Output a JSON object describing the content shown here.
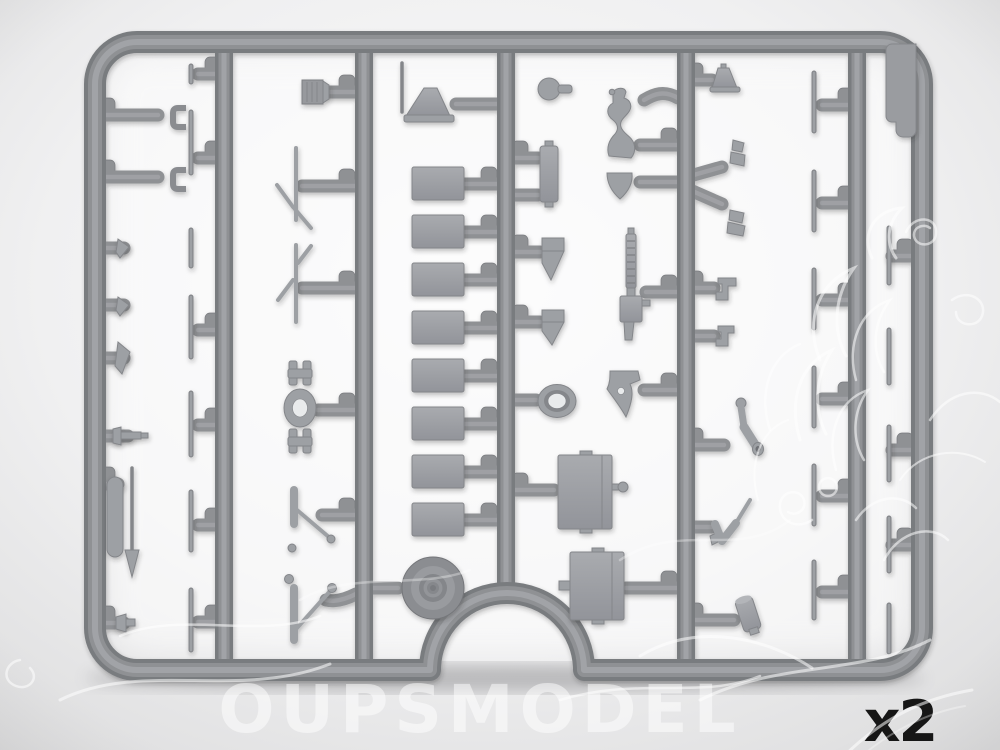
{
  "image": {
    "type": "product-photo",
    "subject": "grey injection-molded plastic model-kit sprue with assorted small parts",
    "sprue": {
      "columns": 6,
      "engine_block_count": 8,
      "road_wheel_count": 1,
      "tool_box_count": 2,
      "parts": [
        "retaining-clips",
        "wedge-brackets",
        "pin-bolt",
        "pill-bar",
        "pointer-rod",
        "rivet-knob",
        "thin-strips",
        "radiator-box",
        "rod-assemblies",
        "coupling-joint",
        "linkage-arms",
        "funnel-horn",
        "engine-blocks",
        "road-wheel",
        "ball-knob",
        "exhaust-pipe",
        "crescent-shield",
        "fuel-cylinder",
        "wedge-fins",
        "machine-gun",
        "oval-pad",
        "gun-mount",
        "tool-boxes",
        "cone-plug",
        "y-branch",
        "step-brackets",
        "elbow-pipe",
        "check-lever",
        "canister",
        "door-panel"
      ]
    }
  },
  "overlay": {
    "quantity_label": "x2",
    "watermark_text": "OUPSMODEL",
    "watermark_logo": "rooster-outline"
  },
  "colors": {
    "background": "#e9e9ea",
    "background-light": "#fafafb",
    "rail": "#8f9194",
    "rail-edge": "#797b7f",
    "rail-light": "#a4a6aa",
    "part": "#9da0a4",
    "part-dark": "#84868a",
    "part-light": "#b1b3b7",
    "hole": "#e9ebec",
    "label": "#161616",
    "watermark": "#ffffff"
  }
}
